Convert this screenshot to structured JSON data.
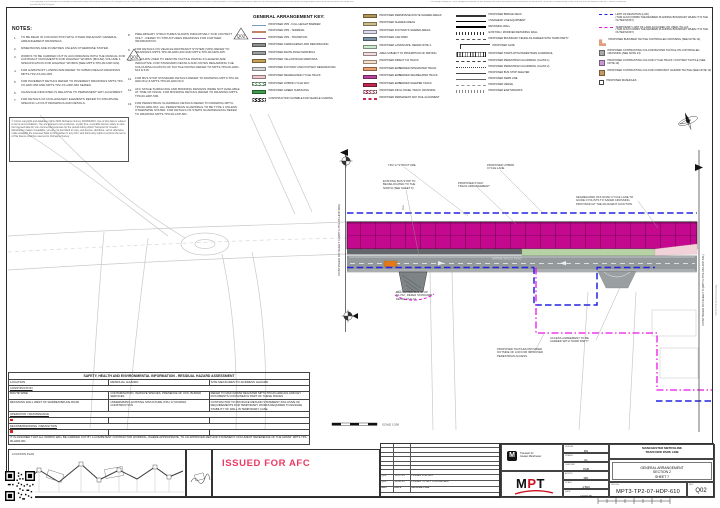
{
  "page": {
    "disclaimer_top_left": "The copyright in this document (including its electronic form) shall remain vested in the Designer but the Client shall have a licence to copy and use the document for the purpose for which it was provided. The Designer shall not be liable for the use by any person of this document for any purpose other than that for which the same was provided by the Designer.",
    "disclaimer_top_right": "The design relating to TfGM equipment detailed on this drawing has been developed from information received from TfGM and is endorsed by TfGM, and use is in accordance with MPT licence conditions.",
    "side_note": "MPT3-TP2-07-HDP-610.dwg"
  },
  "notes": {
    "title": "NOTES:",
    "left": [
      {
        "no": "1.",
        "text": "TO BE READ IN CONJUNCTION WITH OTHER RELEVANT GENERAL ARRANGEMENT DRAWINGS."
      },
      {
        "no": "2.",
        "text": "DIMENSIONS ARE IN METRES UNLESS OTHERWISE STATED."
      },
      {
        "no": "3.",
        "text": "WORKS TO BE CARRIED OUT IN ACCORDANCE WITH THE MANUAL FOR CONTRACT DOCUMENTS FOR HIGHWAY WORKS (MCHW) VOLUME 1, SPECIFICATION FOR HIGHWAY WORKS [SEE MPT3-TP0-00-HSP-001]."
      },
      {
        "no": "4.",
        "text": "FOR HARD/SOFT LANDSCAPE REFER TO URBAN REALM DRAWINGS MPT3-TP2-XX-RG-005."
      },
      {
        "no": "5.",
        "text": "FOR PAVEMENT DETAILS REFER TO PAVEMENT DRAWINGS MPT3-TP2-XX-HDP-650 AND MPT3-TP2-XX-HDP-660 SERIES."
      },
      {
        "no": "6.",
        "text": "CHAINAGE INDICATED IS RELATIVE TO PERMANENT WAY ALIGNMENT."
      },
      {
        "no": "7.",
        "text": "FOR DETAILS OF NON-HIGHWAY ELEMENTS REFER TO DISCIPLINE SPECIFIC LAYOUT DRAWINGS AND DETAILS."
      }
    ],
    "right": [
      {
        "no": "8.",
        "text": "PRELIMINARY STRUCTURES SHOWN INDICATIVELY FOR CONTEXT ONLY - REFER TO STRUCTURES DRAWINGS FOR FURTHER INFORMATION."
      },
      {
        "no": "9.",
        "text": "FOR DETAILS ON VEHICLE RESTRAINT SYSTEM (VRS) REFER TO DRAWINGS MPT3-TP0-00-HRD-403 AND MPT3-TP0-00-HRD-405."
      },
      {
        "no": "10.",
        "text": "COLOURS USED TO DENOTE TACTILE PAVING IN LEGEND ARE INDICATIVE. FOR STANDARD DETAILS AND NOTES REGARDING THE COLOURS/LOCATION OF TACTILE PAVING REFER TO MPT3-TP0-00-HDD-514 & 515."
      },
      {
        "no": "11.",
        "text": "FOR BUS STOP STANDARD DETAILS REFER TO DRAWING MPT3-TP0-00-HDD-512 & MPT3-TP0-00-HDD-513."
      },
      {
        "no": "12.",
        "text": "AFC STAGE SURFACING AND BONDING DESIGNS WERE NOT AVAILABLE AT TIME OF ISSUE. FOR BONDING DETAILS REFER TO DRAWING MPT3-TP0-00-HDP-500."
      },
      {
        "no": "13.",
        "text": "FOR PEDESTRIAN GUARDRAIL DETAILS REFER TO DRAWING MPT3-TP0-00-HDD-510. ALL PEDESTRIAN GUARDRAIL TO BE TYPE 1 UNLESS OTHERWISE STATED. FOR DETAILS OF STEPS GUARDRAILING REFER TO DRAWING MPT3-TP0-00-LDP-601."
      }
    ]
  },
  "copyright": "© Crown copyright and database rights 2015 Ordnance Survey 0100022610. Use of this data is subject to terms and conditions. You are granted a non-exclusive, royalty free, revocable licence solely to view the licensed data for non-commercial purposes for the period during which Transport for Greater Manchester makes it available; you are not permitted to copy, sub-license, distribute, sell or otherwise make available the Licensed Data to third parties in any form; and third party rights to enforce the terms of this licence shall be reserved to Ordnance Survey.",
  "legend": {
    "title": "GENERAL ARRANGEMENT KEY:",
    "col1": [
      {
        "label": "PROPOSED VRS - FULL HEIGHT BARRIER",
        "sw": {
          "kind": "line",
          "color": "#7b9ab5"
        }
      },
      {
        "label": "PROPOSED VRS - TERMINAL",
        "sw": {
          "kind": "line",
          "color": "#c2836a"
        }
      },
      {
        "label": "PROPOSED VRS - TRANSITION",
        "sw": {
          "kind": "line",
          "color": "#8a5d9e"
        }
      },
      {
        "label": "PROPOSED CARRIAGEWAY AND RESURFACING",
        "sw": {
          "kind": "rect",
          "color": "#8d9091"
        }
      },
      {
        "label": "PROPOSED WHITE ROAD MARKINGS",
        "sw": {
          "kind": "rect-stripe",
          "color": "#9aa0a2"
        }
      },
      {
        "label": "PROPOSED YELLOW ROAD MARKINGS",
        "sw": {
          "kind": "rect",
          "color": "#c9a25a"
        }
      },
      {
        "label": "PROPOSED FOOTWAY AND FOOTWAY RESURFACING",
        "sw": {
          "kind": "rect",
          "color": "#d9dbdb"
        }
      },
      {
        "label": "PROPOSED SEGREGATED CYCLE TRACK",
        "sw": {
          "kind": "rect",
          "color": "#f0c9cf"
        }
      },
      {
        "label": "PROPOSED HYBRID CYCLE WAY",
        "sw": {
          "kind": "hatch-green"
        }
      },
      {
        "label": "PROPOSED GREEN SURFACING",
        "sw": {
          "kind": "rect",
          "color": "#3f9e4d"
        }
      },
      {
        "label": "CONSTRUCTION SUITABLE FOR VEHICLE LOADING",
        "sw": {
          "kind": "hatch-black"
        }
      }
    ],
    "col2": [
      {
        "label": "PROPOSED PERMISSIVE ROUTE SHARED AREAS",
        "sw": {
          "kind": "rect",
          "color": "#b3985c"
        }
      },
      {
        "label": "PROPOSED SHARED AREAS",
        "sw": {
          "kind": "rect",
          "color": "#cdbd8a"
        }
      },
      {
        "label": "PROPOSED FOOTWAYS SHARED AREAS",
        "sw": {
          "kind": "rect",
          "color": "#dcdcf0"
        }
      },
      {
        "label": "PROPOSED CAR PARK",
        "sw": {
          "kind": "rect",
          "color": "#7e93a9"
        }
      },
      {
        "label": "PROPOSED LANDSCAPE, REFER NOTE 4.",
        "sw": {
          "kind": "rect",
          "color": "#cdeccd"
        }
      },
      {
        "label": "AREA SUBJECT TO PROHIBITION OF DRIVING",
        "sw": {
          "kind": "rect",
          "color": "#f6dce0"
        }
      },
      {
        "label": "PROPOSED DIRECT FIX TRACK",
        "sw": {
          "kind": "rect",
          "color": "#f8e0c6"
        }
      },
      {
        "label": "PROPOSED EMBEDDED INTEGRATED TRACK",
        "sw": {
          "kind": "rect",
          "color": "#eda070"
        }
      },
      {
        "label": "PROPOSED EMBEDDED SEGREGATED TRACK",
        "sw": {
          "kind": "rect",
          "color": "#b8449c"
        }
      },
      {
        "label": "PROPOSED EMBEDDED SLEEPER TRACK",
        "sw": {
          "kind": "rect",
          "color": "#c22a50"
        }
      },
      {
        "label": "PROPOSED INFILL PANEL TRACK CROSSING",
        "sw": {
          "kind": "hatch-red"
        }
      },
      {
        "label": "PROPOSED PERMANENT WAY RAIL ALIGNMENT",
        "sw": {
          "kind": "rails"
        }
      }
    ],
    "col3": [
      {
        "label": "PROPOSED BRIDGE DECK",
        "sw": {
          "kind": "line-thick",
          "color": "#333333"
        }
      },
      {
        "label": "OVERHEAD LINE EQUIPMENT",
        "sw": {
          "kind": "ole"
        }
      },
      {
        "label": "RETAINING WALL",
        "sw": {
          "kind": "line-thick",
          "color": "#000000"
        }
      },
      {
        "label": "EXISTING / MODIFIED RETAINING WALL",
        "sw": {
          "kind": "ticks",
          "color": "#333333"
        }
      },
      {
        "label": "PROPOSED BOUNDARY FENCE AS AGREED WITH THIRD PARTY",
        "sw": {
          "kind": "dash",
          "color": "#555555"
        }
      },
      {
        "label": "PROPOSED GATE",
        "sw": {
          "kind": "gate"
        }
      },
      {
        "label": "PROPOSED STEPS WITH PEDESTRIAN GUARDRAIL",
        "sw": {
          "kind": "steps"
        }
      },
      {
        "label": "PROPOSED PEDESTRIAN GUARDRAIL (CLASS 1)",
        "sw": {
          "kind": "dashdot",
          "color": "#444444"
        }
      },
      {
        "label": "PROPOSED PEDESTRIAN GUARDRAIL (CLASS 2)",
        "sw": {
          "kind": "dashdot2",
          "color": "#444444"
        }
      },
      {
        "label": "PROPOSED BUS STOP SHELTER",
        "sw": {
          "kind": "busshelter"
        }
      },
      {
        "label": "PROPOSED KERB LINE",
        "sw": {
          "kind": "line",
          "color": "#666666"
        }
      },
      {
        "label": "PROPOSED VERGE",
        "sw": {
          "kind": "dash",
          "color": "#999999"
        }
      },
      {
        "label": "PROPOSED EARTHWORKS",
        "sw": {
          "kind": "ticks",
          "color": "#888888"
        }
      }
    ],
    "col4": [
      {
        "label": "LIMIT OF DEVIATION (LOD)\n(THIS ALSO FORMS THE DESIRED PLANNING BOUNDARY WHEN IT IS THE OUTER MOST.)",
        "sw": {
          "kind": "dash-bold",
          "color": "#2323dd"
        }
      },
      {
        "label": "TEMPORARY LIMIT OF LAND ACQUIRED OR USED (TLLAU)\n(THIS ALSO FORMS THE DESIRED PLANNING BOUNDARY WHEN IT IS THE OUTER MOST.)",
        "sw": {
          "kind": "dashdot-bold",
          "color": "#e219e2"
        }
      },
      {
        "label": "PROPOSED BUFF/RED TACTILE CONTROLLED CROSSING (SEE NOTE 13)",
        "sw": {
          "kind": "L",
          "color": "#e0a080"
        }
      },
      {
        "label": "PROPOSED CONTRASTING COLOUR BLISTER TACTILE ON CONTROLLED CROSSING (SEE NOTE 13)",
        "sw": {
          "kind": "square",
          "color": "#a9a9a9"
        }
      },
      {
        "label": "PROPOSED CONTRASTING COLOUR CYCLE TRACK / FOOTWAY TACTILE (SEE NOTE 13)",
        "sw": {
          "kind": "square",
          "color": "#c79ad4"
        }
      },
      {
        "label": "PROPOSED CONTRASTING COLOUR CORDUROY HAZARD TACTILE (SEE NOTE 13)",
        "sw": {
          "kind": "square",
          "color": "#c79a62"
        }
      },
      {
        "label": "PROPOSED MANHOLES",
        "sw": {
          "kind": "square-outline",
          "color": "#555555"
        }
      }
    ]
  },
  "plan": {
    "matchline_left": "CONTINUED ON SHEET 6 (MPT3-TP2-06-HDP-609)",
    "matchline_right": "CONTINUED ON SHEET 8 (MPT3-TP2-08-HDP-611)",
    "street_label": "WARREN BRUCE ROAD",
    "ole_label": "OLE",
    "scale_label": "SCALE 1:500",
    "annotations": [
      {
        "text": "TRU 17 STRUCTURE",
        "x": 388,
        "y": 164
      },
      {
        "text": "EXISTING BUS STOP TO\nBE RELOCATED TO THE\nNORTH (SEE SHEET 6)",
        "x": 383,
        "y": 180
      },
      {
        "text": "PROPOSED HYBRID\nCYCLE LANE",
        "x": 487,
        "y": 164
      },
      {
        "text": "PROPOSED P-WAY\nTRACK ARRANGEMENT",
        "x": 458,
        "y": 182
      },
      {
        "text": "SEGREGATED OFF ROAD CYCLE LANE TO\nGUIDE CYCLISTS TO SAFER CROSSING\nPROVISION AT THE ADJACENT JUNCTION.",
        "x": 576,
        "y": 196
      },
      {
        "text": "RELOCATED BUS STOP\n'ELY02', REFER STANDARD\nDETAIL 07-E-01",
        "x": 396,
        "y": 291
      },
      {
        "text": "ACCESS AGREEMENT TO BE\nAGREED WITH THIRD PARTY",
        "x": 550,
        "y": 337
      },
      {
        "text": "PROPOSED TACTILES PROVIDED\nOUTSIDE OF LOD FOR IMPROVED\nPEDESTRIAN ACCESS.",
        "x": 497,
        "y": 348
      }
    ]
  },
  "markers": {
    "q02": "Q02"
  },
  "hazard": {
    "title": "SAFETY, HEALTH AND ENVIRONMENTAL INFORMATION - RESIDUAL HAZARD ASSESSMENT",
    "headers": [
      "LOCATION",
      "RESIDUAL HAZARD",
      "SITE MEASURES TO ADDRESS HAZARD"
    ],
    "rows": [
      {
        "type": "section",
        "label": "CONSTRUCTION"
      },
      {
        "type": "row",
        "cells": [
          "ROUTE WIDE",
          "CONTAMINATION, INVASIVE SPECIES, PRESENCE OF UXO, BURIED SERVICES",
          "REFER TO MAIN HDMW REGISTER MPT3-TP0-00-HDR-001 AND KEY DOCUMENTS CONTAINED IN PART OF THESE ISSUES"
        ]
      },
      {
        "type": "row",
        "cells": [
          "RETAINING WALL WEST OF WARREN BRUCE ROAD",
          "UNDERMINING EXISTING STRUCTURE (TRU 17) DURING CONSTRUCTION",
          "CONTRACTOR TO PRODUCE METHOD STATEMENT INCLUSIVE OF REQUIREMENTS FOR TEMPORARY WORKS REQUIRED TO ENSURE STABILITY OF WALL IN TEMPORARY CASE."
        ]
      },
      {
        "type": "section",
        "label": "OPERATION / MAINTENANCE"
      },
      {
        "type": "row",
        "marker": true,
        "cells": [
          "",
          "",
          ""
        ]
      },
      {
        "type": "section",
        "label": "DECOMMISSIONING / DEMOLITION"
      },
      {
        "type": "row",
        "marker": true,
        "cells": [
          "",
          "",
          ""
        ]
      }
    ],
    "footnote": "IT IS ASSUMED THAT ALL WORKS WILL BE CARRIED OUT BY A COMPETENT CONTRACTOR WORKING, WHERE APPROPRIATE, TO AN APPROVED METHOD STATEMENT. DOCUMENT REFERENCE OF THE HDMW: MPT3-TP0-00-HDR-001."
  },
  "stamp": {
    "text": "ISSUED FOR AFC",
    "color": "#ea3a63"
  },
  "location": {
    "label": "LOCATION PLAN"
  },
  "revisions": {
    "headers": [
      "REV",
      "DATE",
      "DESCRIPTION"
    ],
    "empty_rows": 7,
    "rows": [
      [
        "Q02",
        "10.07.15",
        "ISSUED FOR AFC"
      ],
      [
        "Q01",
        "19.06.15",
        "ISSUED TO MPT FOR REVIEW"
      ]
    ]
  },
  "title_block": {
    "tfgm_name": "Transport for\nGreater Manchester",
    "mpt_m": "M",
    "mpt_p": "P",
    "mpt_t": "T",
    "project": "MANCHESTER METROLINK\nTRAFFORD PARK LINE",
    "title": "GENERAL ARRANGEMENT\nSECTION 2\nSHEET 7",
    "drg_label": "DRG No.",
    "drg_no": "MPT3-TP2-07-HDP-610",
    "rev_label": "REV",
    "rev": "Q02",
    "fields": [
      {
        "label": "DESIGN",
        "value": "RG"
      },
      {
        "label": "DRAWN",
        "value": "CL"
      },
      {
        "label": "CHECKED",
        "value": "PAB"
      },
      {
        "label": "APPR'D",
        "value": "MD"
      },
      {
        "label": "SCALE",
        "value": "1:500"
      },
      {
        "label": "DATE",
        "value": "10.07.15"
      }
    ]
  }
}
